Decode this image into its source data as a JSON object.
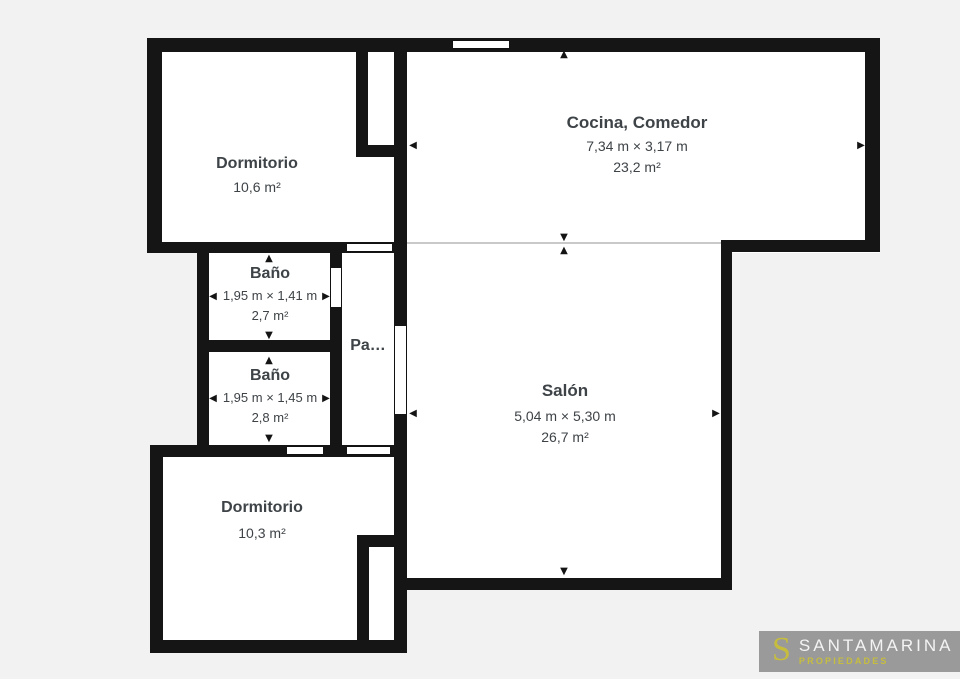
{
  "rooms": {
    "dormitorio_top": {
      "name": "Dormitorio",
      "area": "10,6 m²"
    },
    "cocina_comedor": {
      "name": "Cocina, Comedor",
      "dimensions": "7,34 m × 3,17 m",
      "area": "23,2 m²"
    },
    "bano_1": {
      "name": "Baño",
      "dimensions": "1,95 m × 1,41 m",
      "area": "2,7 m²"
    },
    "bano_2": {
      "name": "Baño",
      "dimensions": "1,95 m × 1,45 m",
      "area": "2,8 m²"
    },
    "pasillo": {
      "name": "Pa…"
    },
    "salon": {
      "name": "Salón",
      "dimensions": "5,04 m × 5,30 m",
      "area": "26,7 m²"
    },
    "dormitorio_bottom": {
      "name": "Dormitorio",
      "area": "10,3 m²"
    }
  },
  "icons": {
    "arrow_up": "▲",
    "arrow_down": "▼",
    "arrow_left": "◀",
    "arrow_right": "▶"
  },
  "colors": {
    "wall": "#151515",
    "background": "#f2f2f2",
    "room_fill": "#ffffff",
    "text": "#3e4347",
    "separator": "#c9c9c9",
    "logo_background": "#9a9a9a",
    "logo_accent": "#c6bd3f",
    "logo_brand_text": "#f4f4f4"
  },
  "logo": {
    "monogram": "S",
    "brand": "SANTAMARINA",
    "tagline": "PROPIEDADES"
  }
}
